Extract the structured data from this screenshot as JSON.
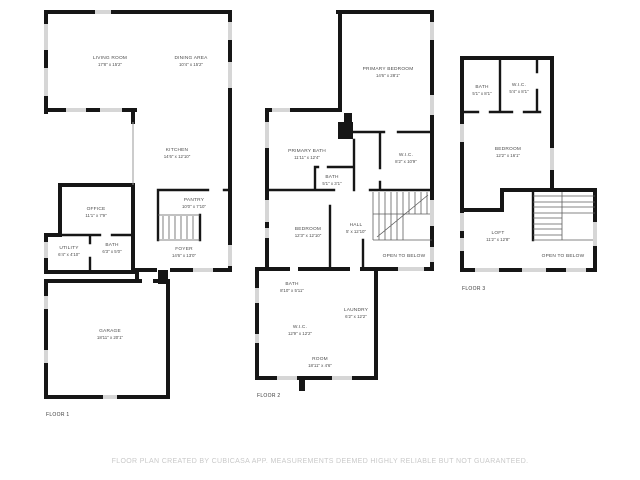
{
  "footer": {
    "disclaimer": "FLOOR PLAN CREATED BY CUBICASA APP. MEASUREMENTS DEEMED HIGHLY RELIABLE BUT NOT GUARANTEED."
  },
  "floor1": {
    "label": "FLOOR 1",
    "rooms": {
      "living": {
        "name": "LIVING ROOM",
        "dims": "17'8\" x 15'2\""
      },
      "dining": {
        "name": "DINING AREA",
        "dims": "10'4\" x 15'2\""
      },
      "kitchen": {
        "name": "KITCHEN",
        "dims": "14'6\" x 12'10\""
      },
      "office": {
        "name": "OFFICE",
        "dims": "11'1\" x 7'9\""
      },
      "utility": {
        "name": "UTILITY",
        "dims": "6'4\" x 4'10\""
      },
      "bath": {
        "name": "BATH",
        "dims": "6'3\" x 5'0\""
      },
      "pantry": {
        "name": "PANTRY",
        "dims": "10'0\" x 7'10\""
      },
      "foyer": {
        "name": "FOYER",
        "dims": "14'6\" x 13'0\""
      },
      "garage": {
        "name": "GARAGE",
        "dims": "18'11\" x 20'1\""
      }
    }
  },
  "floor2": {
    "label": "FLOOR 2",
    "rooms": {
      "primary_bedroom": {
        "name": "PRIMARY BEDROOM",
        "dims": "14'6\" x 28'1\""
      },
      "primary_bath": {
        "name": "PRIMARY BATH",
        "dims": "11'11\" x 12'4\""
      },
      "wic_upper": {
        "name": "W.I.C.",
        "dims": "8'2\" x 10'9\""
      },
      "bath_small": {
        "name": "BATH",
        "dims": "5'1\" x 3'1\""
      },
      "bedroom": {
        "name": "BEDROOM",
        "dims": "12'3\" x 12'10\""
      },
      "hall": {
        "name": "HALL",
        "dims": "5' x 12'10\""
      },
      "open_below": {
        "name": "OPEN TO BELOW"
      },
      "bath_lower": {
        "name": "BATH",
        "dims": "8'10\" x 5'11\""
      },
      "laundry": {
        "name": "LAUNDRY",
        "dims": "6'2\" x 12'2\""
      },
      "wic_lower": {
        "name": "W.I.C.",
        "dims": "12'9\" x 12'2\""
      },
      "room": {
        "name": "ROOM",
        "dims": "18'11\" x 4'6\""
      }
    }
  },
  "floor3": {
    "label": "FLOOR 3",
    "rooms": {
      "bath": {
        "name": "BATH",
        "dims": "5'1\" x 8'1\""
      },
      "wic": {
        "name": "W.I.C.",
        "dims": "5'4\" x 8'1\""
      },
      "bedroom": {
        "name": "BEDROOM",
        "dims": "12'2\" x 16'1\""
      },
      "loft": {
        "name": "LOFT",
        "dims": "11'2\" x 12'8\""
      },
      "open_below": {
        "name": "OPEN TO BELOW"
      }
    }
  },
  "colors": {
    "wall": "#161616",
    "window": "#d6d6d6",
    "label": "#4c4c4c",
    "footer": "#c9c9c9"
  }
}
